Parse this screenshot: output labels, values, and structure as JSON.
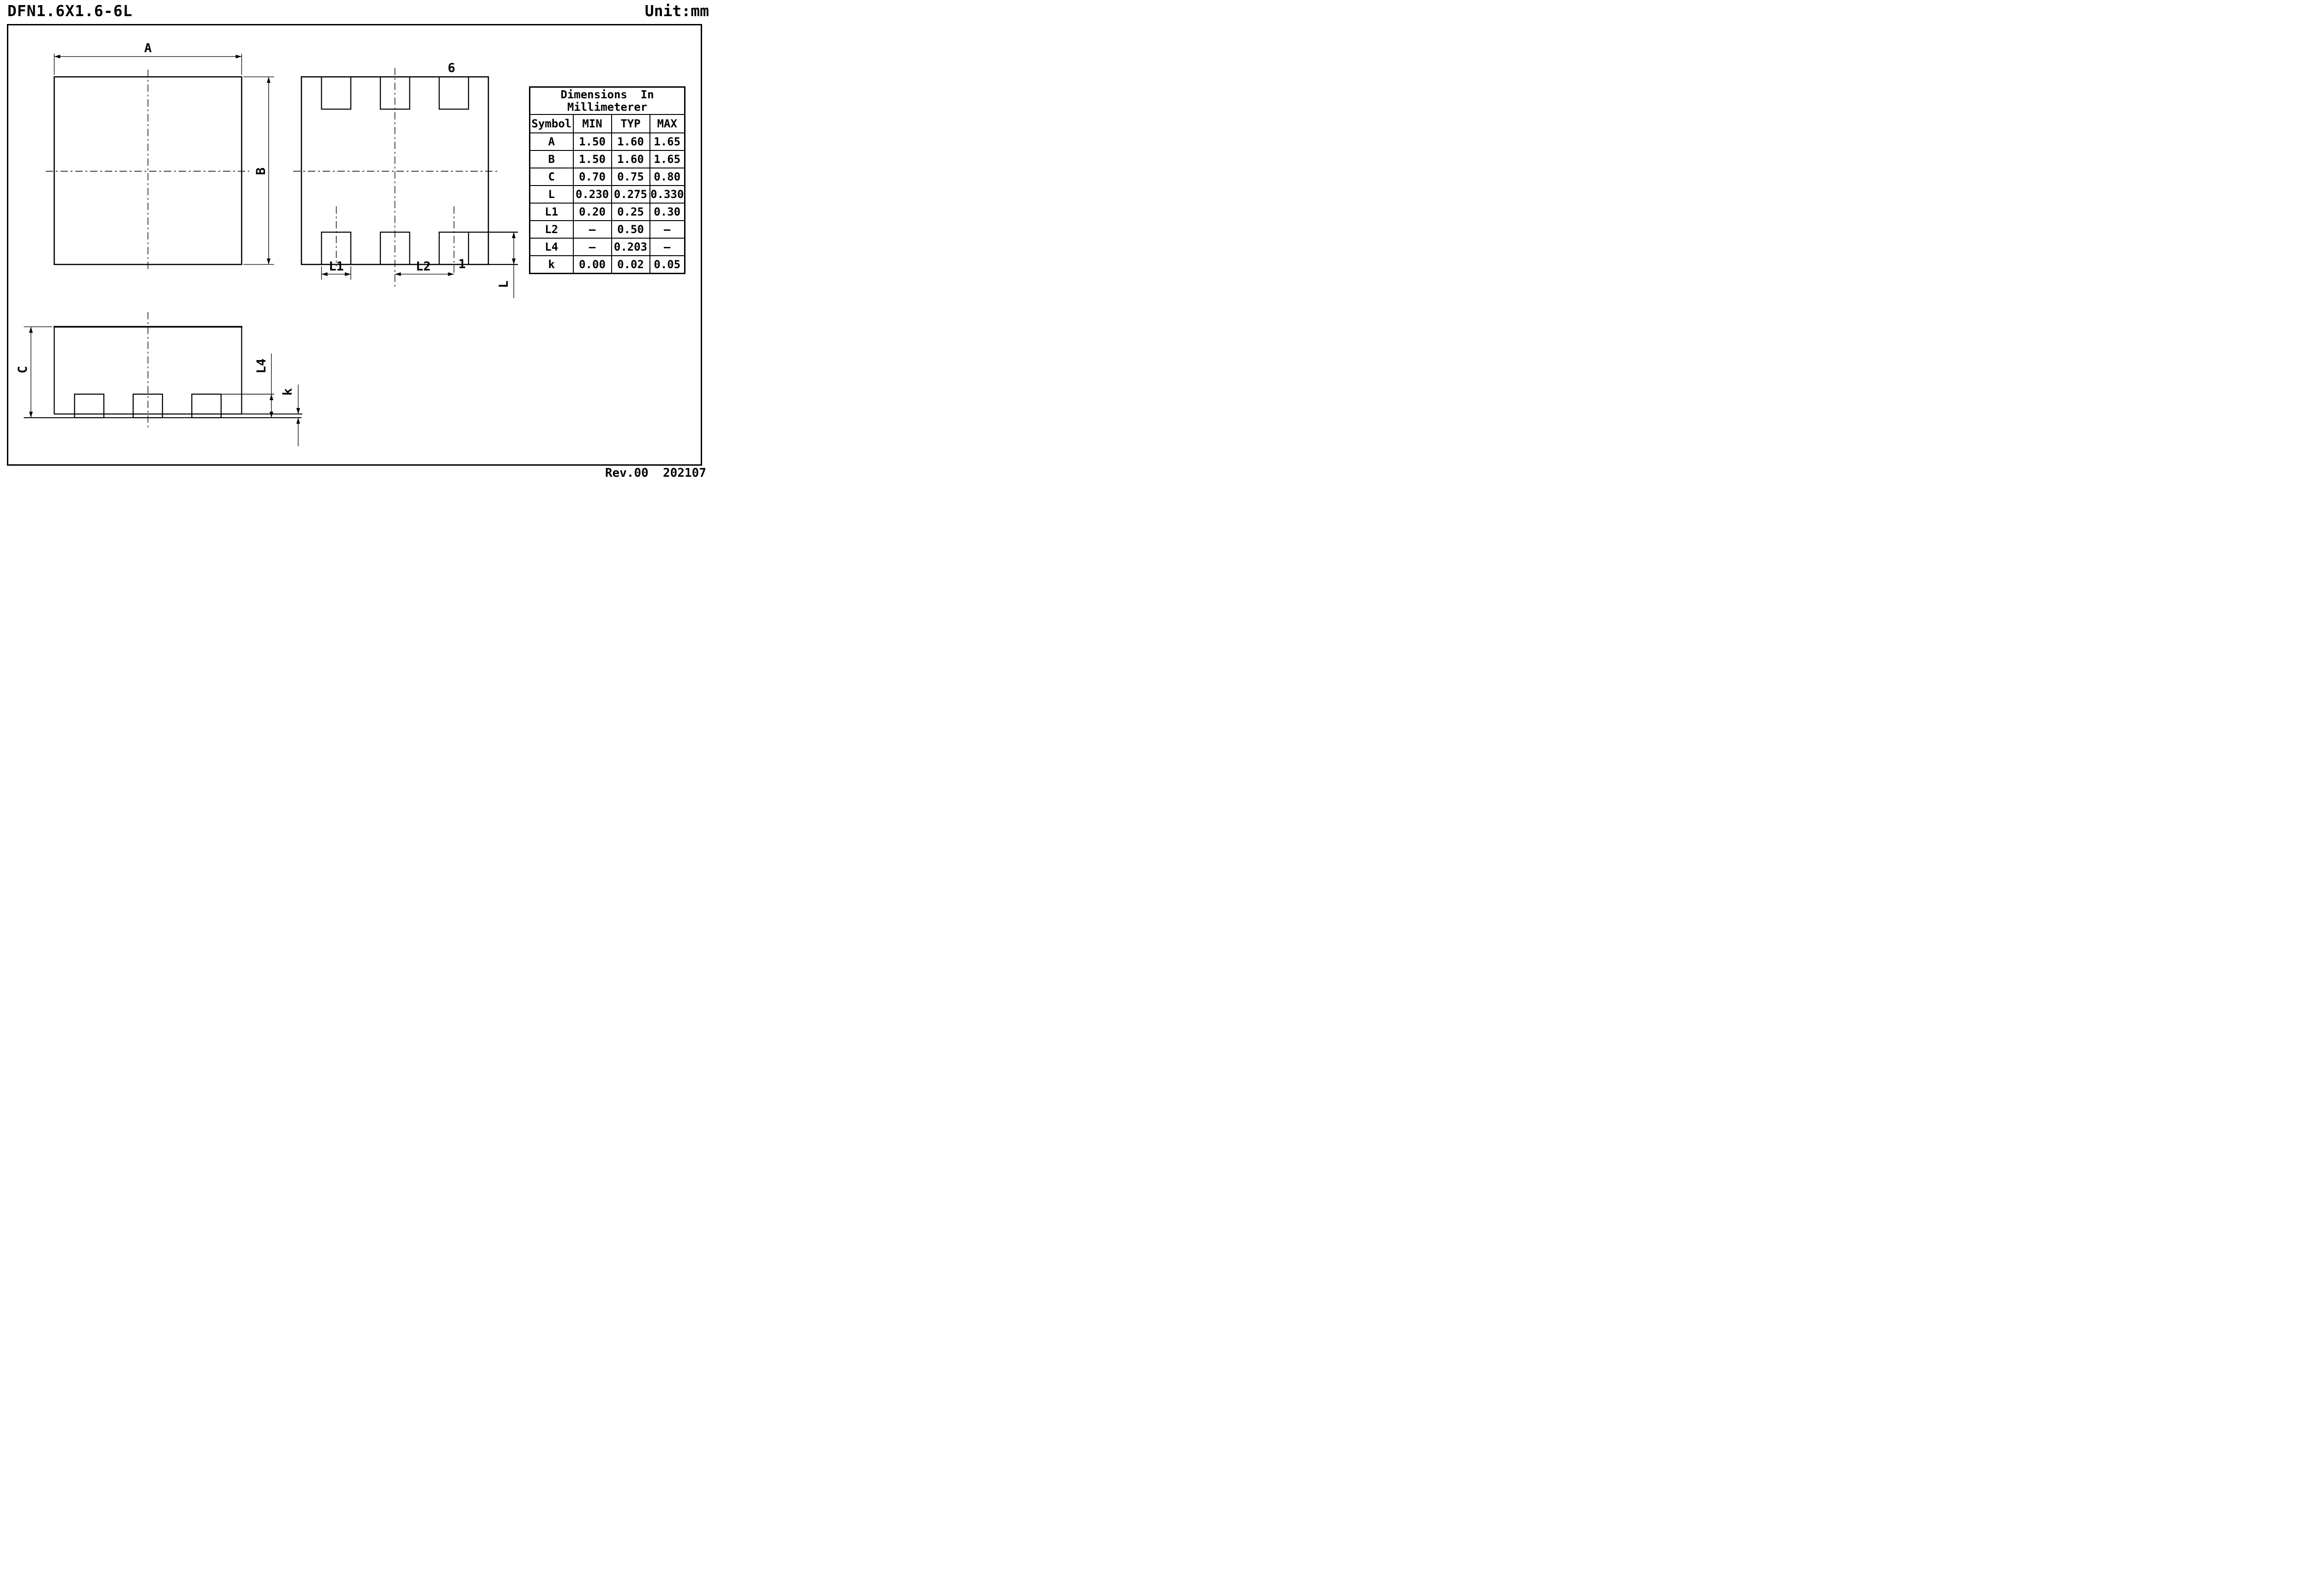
{
  "header": {
    "title": "DFN1.6X1.6-6L",
    "unit_label": "Unit:mm"
  },
  "footer": {
    "revision": "Rev.00  202107"
  },
  "views": {
    "top_view": {
      "dim_width": "A",
      "dim_height": "B"
    },
    "bottom_view": {
      "pin_top_right": "6",
      "pin_bottom_right": "1",
      "dim_pad_width": "L1",
      "dim_pad_pitch": "L2",
      "dim_pad_length": "L"
    },
    "side_view": {
      "dim_body_height": "C",
      "dim_lead_thickness": "L4",
      "dim_standoff": "k"
    }
  },
  "table": {
    "title_line1": "Dimensions  In",
    "title_line2": "Millimeterer",
    "columns": [
      "Symbol",
      "MIN",
      "TYP",
      "MAX"
    ],
    "rows": [
      {
        "symbol": "A",
        "min": "1.50",
        "typ": "1.60",
        "max": "1.65"
      },
      {
        "symbol": "B",
        "min": "1.50",
        "typ": "1.60",
        "max": "1.65"
      },
      {
        "symbol": "C",
        "min": "0.70",
        "typ": "0.75",
        "max": "0.80"
      },
      {
        "symbol": "L",
        "min": "0.230",
        "typ": "0.275",
        "max": "0.330"
      },
      {
        "symbol": "L1",
        "min": "0.20",
        "typ": "0.25",
        "max": "0.30"
      },
      {
        "symbol": "L2",
        "min": "–",
        "typ": "0.50",
        "max": "–"
      },
      {
        "symbol": "L4",
        "min": "–",
        "typ": "0.203",
        "max": "–"
      },
      {
        "symbol": "k",
        "min": "0.00",
        "typ": "0.02",
        "max": "0.05"
      }
    ]
  }
}
